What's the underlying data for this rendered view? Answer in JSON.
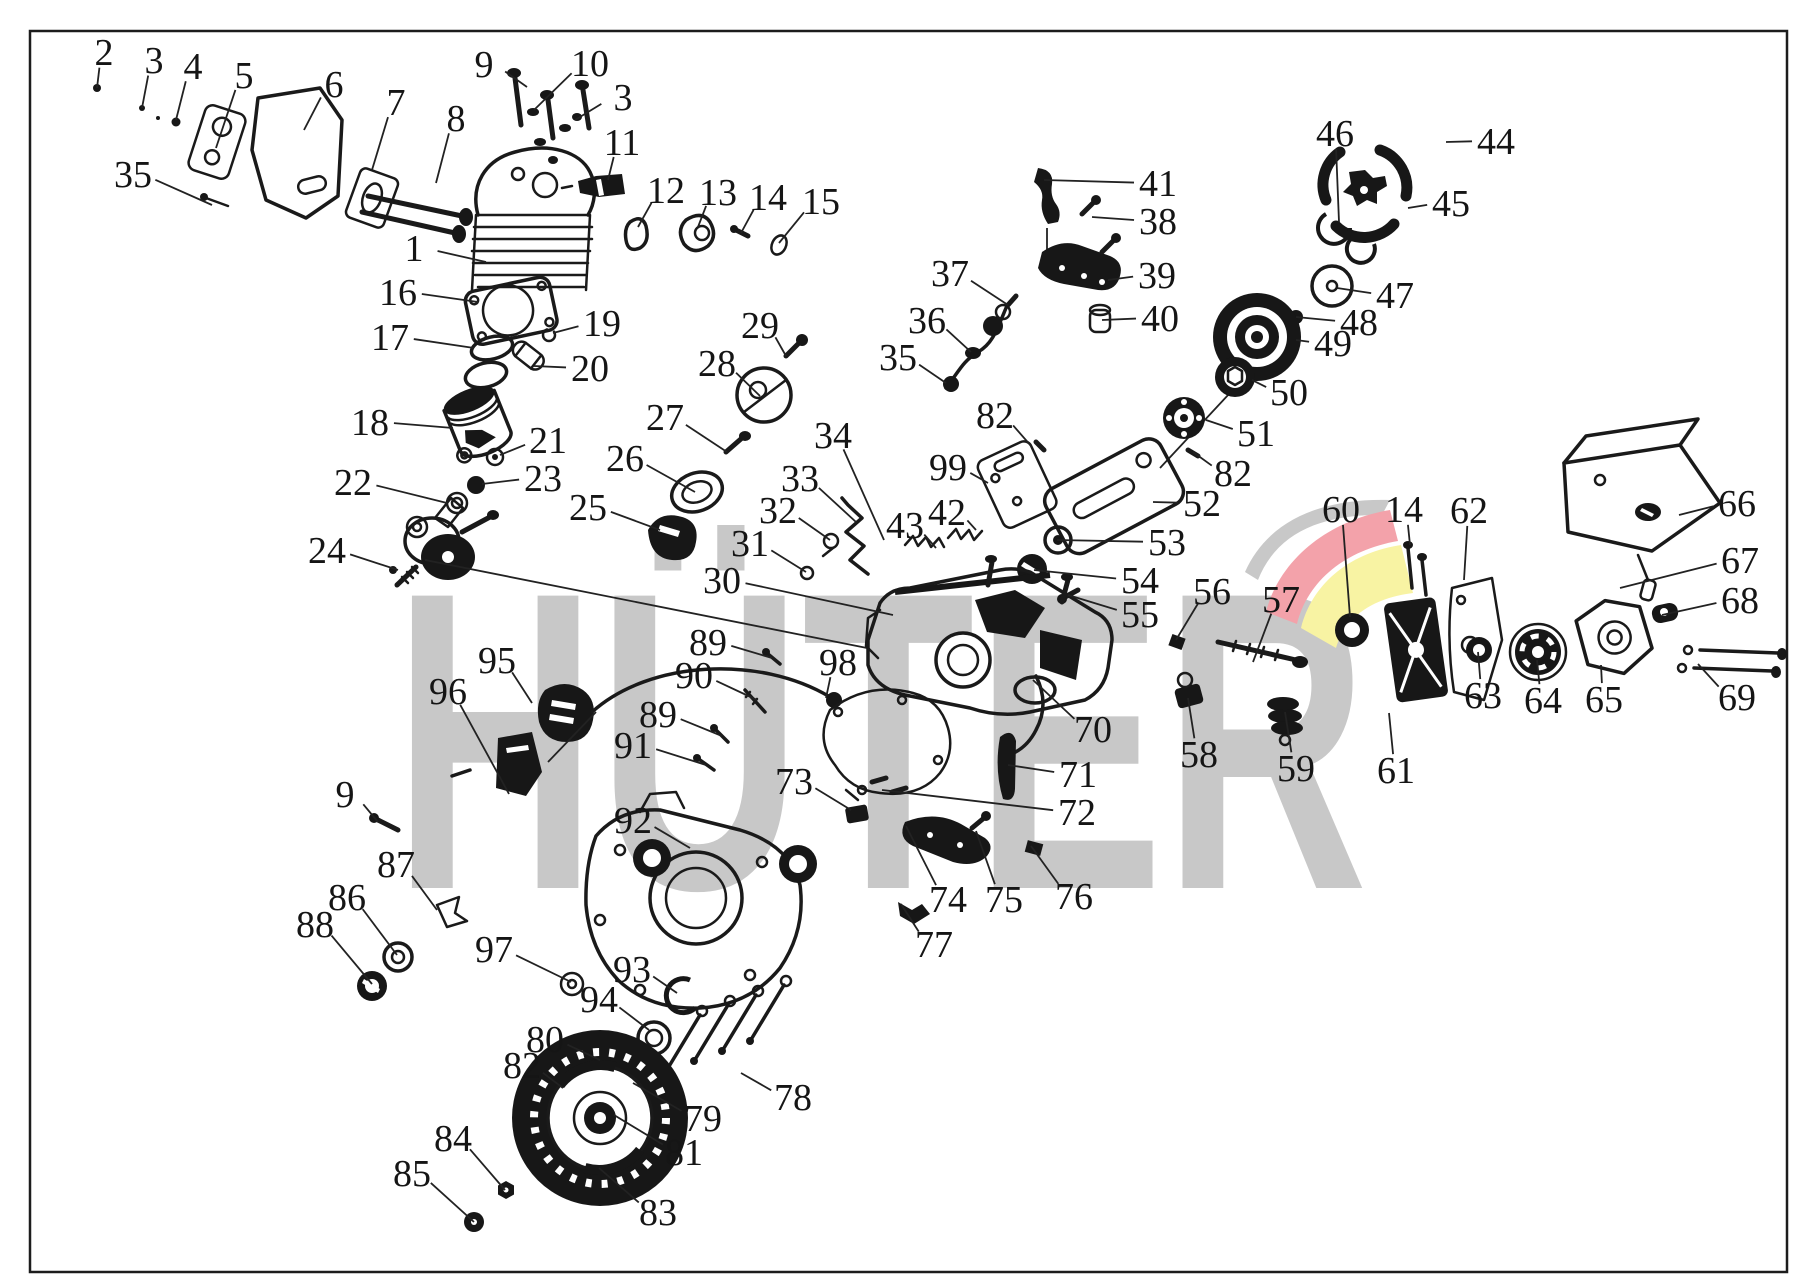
{
  "page": {
    "background": "#ffffff",
    "frame_color": "#1c1c1c",
    "ink_color": "#1a1a1a"
  },
  "watermark": {
    "text": "HÜTER",
    "color": "#c8c8c8",
    "swoosh_gray": "#c8c8c8",
    "swoosh_red": "#f3a2aa",
    "swoosh_yellow": "#f8f3a3"
  },
  "callouts": [
    {
      "n": "2",
      "x": 104,
      "y": 52,
      "tx": 97,
      "ty": 88
    },
    {
      "n": "3",
      "x": 154,
      "y": 60,
      "tx": 142,
      "ty": 108
    },
    {
      "n": "4",
      "x": 193,
      "y": 66,
      "tx": 176,
      "ty": 120
    },
    {
      "n": "5",
      "x": 244,
      "y": 75,
      "tx": 216,
      "ty": 148
    },
    {
      "n": "6",
      "x": 334,
      "y": 84,
      "tx": 304,
      "ty": 130
    },
    {
      "n": "7",
      "x": 396,
      "y": 102,
      "tx": 372,
      "ty": 170
    },
    {
      "n": "8",
      "x": 456,
      "y": 118,
      "tx": 436,
      "ty": 183
    },
    {
      "n": "9",
      "x": 484,
      "y": 64,
      "tx": 527,
      "ty": 87
    },
    {
      "n": "10",
      "x": 590,
      "y": 63,
      "tx": 534,
      "ty": 110
    },
    {
      "n": "3",
      "x": 623,
      "y": 97,
      "tx": 575,
      "ty": 120
    },
    {
      "n": "35",
      "x": 133,
      "y": 174,
      "tx": 212,
      "ty": 205
    },
    {
      "n": "11",
      "x": 622,
      "y": 142,
      "tx": 608,
      "ty": 180
    },
    {
      "n": "1",
      "x": 414,
      "y": 248,
      "tx": 486,
      "ty": 262
    },
    {
      "n": "12",
      "x": 666,
      "y": 190,
      "tx": 638,
      "ty": 227
    },
    {
      "n": "13",
      "x": 718,
      "y": 192,
      "tx": 698,
      "ty": 227
    },
    {
      "n": "14",
      "x": 768,
      "y": 197,
      "tx": 741,
      "ty": 233
    },
    {
      "n": "15",
      "x": 821,
      "y": 201,
      "tx": 779,
      "ty": 243
    },
    {
      "n": "16",
      "x": 398,
      "y": 292,
      "tx": 478,
      "ty": 302
    },
    {
      "n": "17",
      "x": 390,
      "y": 337,
      "tx": 474,
      "ty": 348
    },
    {
      "n": "19",
      "x": 602,
      "y": 323,
      "tx": 553,
      "ty": 333
    },
    {
      "n": "20",
      "x": 590,
      "y": 368,
      "tx": 534,
      "ty": 366
    },
    {
      "n": "18",
      "x": 370,
      "y": 422,
      "tx": 453,
      "ty": 428
    },
    {
      "n": "21",
      "x": 548,
      "y": 440,
      "tx": 500,
      "ty": 455
    },
    {
      "n": "23",
      "x": 543,
      "y": 478,
      "tx": 482,
      "ty": 484
    },
    {
      "n": "22",
      "x": 353,
      "y": 482,
      "tx": 447,
      "ty": 503
    },
    {
      "n": "24",
      "x": 327,
      "y": 550,
      "tx": 398,
      "ty": 570
    },
    {
      "n": "25",
      "x": 588,
      "y": 507,
      "tx": 660,
      "ty": 530
    },
    {
      "n": "26",
      "x": 625,
      "y": 458,
      "tx": 695,
      "ty": 492
    },
    {
      "n": "27",
      "x": 665,
      "y": 417,
      "tx": 727,
      "ty": 452
    },
    {
      "n": "28",
      "x": 717,
      "y": 363,
      "tx": 760,
      "ty": 396
    },
    {
      "n": "29",
      "x": 760,
      "y": 325,
      "tx": 786,
      "ty": 356
    },
    {
      "n": "34",
      "x": 833,
      "y": 435,
      "tx": 884,
      "ty": 540
    },
    {
      "n": "33",
      "x": 800,
      "y": 478,
      "tx": 856,
      "ty": 522
    },
    {
      "n": "32",
      "x": 778,
      "y": 510,
      "tx": 830,
      "ty": 540
    },
    {
      "n": "31",
      "x": 750,
      "y": 543,
      "tx": 806,
      "ty": 572
    },
    {
      "n": "30",
      "x": 722,
      "y": 580,
      "tx": 893,
      "ty": 615
    },
    {
      "n": "43",
      "x": 905,
      "y": 525,
      "tx": 936,
      "ty": 548
    },
    {
      "n": "42",
      "x": 947,
      "y": 512,
      "tx": 976,
      "ty": 530
    },
    {
      "n": "37",
      "x": 950,
      "y": 273,
      "tx": 1008,
      "ty": 305
    },
    {
      "n": "36",
      "x": 927,
      "y": 320,
      "tx": 971,
      "ty": 352
    },
    {
      "n": "35",
      "x": 898,
      "y": 357,
      "tx": 946,
      "ty": 383
    },
    {
      "n": "41",
      "x": 1158,
      "y": 183,
      "tx": 1044,
      "ty": 180
    },
    {
      "n": "38",
      "x": 1158,
      "y": 221,
      "tx": 1092,
      "ty": 217
    },
    {
      "n": "39",
      "x": 1157,
      "y": 275,
      "tx": 1108,
      "ty": 280
    },
    {
      "n": "40",
      "x": 1160,
      "y": 318,
      "tx": 1102,
      "ty": 320
    },
    {
      "n": "82",
      "x": 995,
      "y": 415,
      "tx": 1032,
      "ty": 447
    },
    {
      "n": "99",
      "x": 948,
      "y": 467,
      "tx": 988,
      "ty": 483
    },
    {
      "n": "46",
      "x": 1335,
      "y": 133,
      "tx": 1339,
      "ty": 222
    },
    {
      "n": "44",
      "x": 1496,
      "y": 141,
      "tx": 1446,
      "ty": 142
    },
    {
      "n": "45",
      "x": 1451,
      "y": 203,
      "tx": 1408,
      "ty": 208
    },
    {
      "n": "47",
      "x": 1395,
      "y": 295,
      "tx": 1337,
      "ty": 288
    },
    {
      "n": "48",
      "x": 1359,
      "y": 322,
      "tx": 1296,
      "ty": 317
    },
    {
      "n": "49",
      "x": 1333,
      "y": 343,
      "tx": 1296,
      "ty": 340
    },
    {
      "n": "50",
      "x": 1289,
      "y": 392,
      "tx": 1252,
      "ty": 380
    },
    {
      "n": "51",
      "x": 1256,
      "y": 433,
      "tx": 1206,
      "ty": 420
    },
    {
      "n": "82",
      "x": 1233,
      "y": 473,
      "tx": 1193,
      "ty": 452
    },
    {
      "n": "52",
      "x": 1202,
      "y": 503,
      "tx": 1153,
      "ty": 502
    },
    {
      "n": "53",
      "x": 1167,
      "y": 542,
      "tx": 1057,
      "ty": 540
    },
    {
      "n": "54",
      "x": 1140,
      "y": 580,
      "tx": 1034,
      "ty": 570
    },
    {
      "n": "55",
      "x": 1140,
      "y": 614,
      "tx": 1068,
      "ty": 595
    },
    {
      "n": "56",
      "x": 1212,
      "y": 591,
      "tx": 1176,
      "ty": 640
    },
    {
      "n": "57",
      "x": 1281,
      "y": 599,
      "tx": 1253,
      "ty": 662
    },
    {
      "n": "60",
      "x": 1341,
      "y": 509,
      "tx": 1350,
      "ty": 617
    },
    {
      "n": "14",
      "x": 1404,
      "y": 509,
      "tx": 1410,
      "ty": 545
    },
    {
      "n": "62",
      "x": 1469,
      "y": 510,
      "tx": 1464,
      "ty": 580
    },
    {
      "n": "66",
      "x": 1737,
      "y": 503,
      "tx": 1679,
      "ty": 515
    },
    {
      "n": "67",
      "x": 1740,
      "y": 560,
      "tx": 1620,
      "ty": 588
    },
    {
      "n": "68",
      "x": 1740,
      "y": 600,
      "tx": 1662,
      "ty": 615
    },
    {
      "n": "69",
      "x": 1737,
      "y": 697,
      "tx": 1698,
      "ty": 664
    },
    {
      "n": "63",
      "x": 1483,
      "y": 695,
      "tx": 1478,
      "ty": 652
    },
    {
      "n": "64",
      "x": 1543,
      "y": 700,
      "tx": 1537,
      "ty": 660
    },
    {
      "n": "65",
      "x": 1604,
      "y": 699,
      "tx": 1601,
      "ty": 665
    },
    {
      "n": "59",
      "x": 1296,
      "y": 768,
      "tx": 1285,
      "ty": 712
    },
    {
      "n": "61",
      "x": 1396,
      "y": 770,
      "tx": 1389,
      "ty": 713
    },
    {
      "n": "58",
      "x": 1199,
      "y": 754,
      "tx": 1188,
      "ty": 698
    },
    {
      "n": "70",
      "x": 1093,
      "y": 729,
      "tx": 1033,
      "ty": 680
    },
    {
      "n": "71",
      "x": 1078,
      "y": 774,
      "tx": 1008,
      "ty": 765
    },
    {
      "n": "72",
      "x": 1077,
      "y": 812,
      "tx": 882,
      "ty": 790
    },
    {
      "n": "89",
      "x": 708,
      "y": 642,
      "tx": 772,
      "ty": 658
    },
    {
      "n": "90",
      "x": 694,
      "y": 675,
      "tx": 757,
      "ty": 700
    },
    {
      "n": "89",
      "x": 658,
      "y": 714,
      "tx": 722,
      "ty": 736
    },
    {
      "n": "91",
      "x": 633,
      "y": 745,
      "tx": 706,
      "ty": 765
    },
    {
      "n": "98",
      "x": 838,
      "y": 662,
      "tx": 826,
      "ty": 698
    },
    {
      "n": "95",
      "x": 497,
      "y": 660,
      "tx": 532,
      "ty": 703
    },
    {
      "n": "96",
      "x": 448,
      "y": 691,
      "tx": 509,
      "ty": 794
    },
    {
      "n": "9",
      "x": 345,
      "y": 794,
      "tx": 378,
      "ty": 822
    },
    {
      "n": "92",
      "x": 633,
      "y": 820,
      "tx": 690,
      "ty": 848
    },
    {
      "n": "73",
      "x": 794,
      "y": 781,
      "tx": 851,
      "ty": 810
    },
    {
      "n": "74",
      "x": 948,
      "y": 899,
      "tx": 906,
      "ty": 826
    },
    {
      "n": "75",
      "x": 1004,
      "y": 899,
      "tx": 976,
      "ty": 831
    },
    {
      "n": "76",
      "x": 1074,
      "y": 896,
      "tx": 1031,
      "ty": 846
    },
    {
      "n": "77",
      "x": 934,
      "y": 944,
      "tx": 901,
      "ty": 904
    },
    {
      "n": "87",
      "x": 396,
      "y": 864,
      "tx": 437,
      "ty": 910
    },
    {
      "n": "86",
      "x": 347,
      "y": 897,
      "tx": 397,
      "ty": 955
    },
    {
      "n": "88",
      "x": 315,
      "y": 924,
      "tx": 372,
      "ty": 984
    },
    {
      "n": "97",
      "x": 494,
      "y": 949,
      "tx": 571,
      "ty": 982
    },
    {
      "n": "93",
      "x": 632,
      "y": 969,
      "tx": 677,
      "ty": 993
    },
    {
      "n": "94",
      "x": 599,
      "y": 999,
      "tx": 649,
      "ty": 1030
    },
    {
      "n": "80",
      "x": 545,
      "y": 1039,
      "tx": 600,
      "ty": 1060
    },
    {
      "n": "82",
      "x": 522,
      "y": 1065,
      "tx": 563,
      "ty": 1088
    },
    {
      "n": "78",
      "x": 793,
      "y": 1097,
      "tx": 741,
      "ty": 1073
    },
    {
      "n": "79",
      "x": 703,
      "y": 1118,
      "tx": 633,
      "ty": 1083
    },
    {
      "n": "81",
      "x": 684,
      "y": 1152,
      "tx": 614,
      "ty": 1115
    },
    {
      "n": "84",
      "x": 453,
      "y": 1138,
      "tx": 505,
      "ty": 1190
    },
    {
      "n": "85",
      "x": 412,
      "y": 1173,
      "tx": 474,
      "ty": 1222
    },
    {
      "n": "83",
      "x": 658,
      "y": 1212,
      "tx": 599,
      "ty": 1168
    }
  ]
}
